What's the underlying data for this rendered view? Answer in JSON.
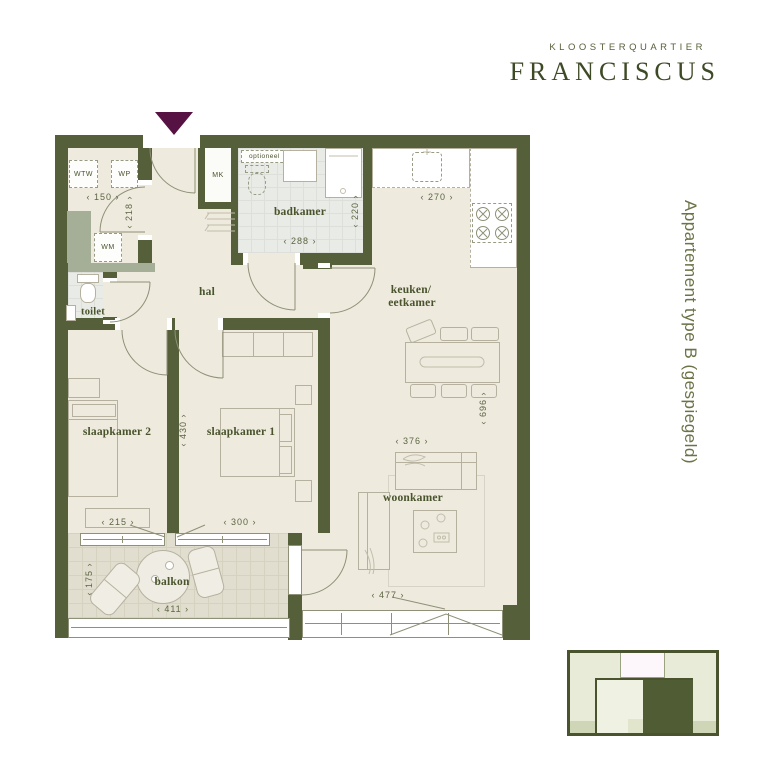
{
  "brand": {
    "subtitle": "KLOOSTERQUARTIER",
    "title": "FRANCISCUS"
  },
  "side_label": "Appartement type B (gespiegeld)",
  "rooms": {
    "badkamer": "badkamer",
    "hal": "hal",
    "toilet": "toilet",
    "keuken_line1": "keuken/",
    "keuken_line2": "eetkamer",
    "slaapkamer2": "slaapkamer 2",
    "slaapkamer1": "slaapkamer 1",
    "woonkamer": "woonkamer",
    "balkon": "balkon"
  },
  "closets": {
    "wtw": "WTW",
    "wp": "WP",
    "wm": "WM",
    "mk": "MK",
    "optioneel": "optioneel"
  },
  "dimensions_cm": {
    "entree_width": "‹ 150 ›",
    "entree_depth": "‹ 218 ›",
    "badkamer_width": "‹ 288 ›",
    "badkamer_depth": "‹ 220 ›",
    "keuken_width": "‹ 270 ›",
    "keuken_depth": "‹ 696 ›",
    "slaapkamer2_width": "‹ 215 ›",
    "slaapkamer1_width": "‹ 300 ›",
    "slaapkamer_depth": "‹ 430 ›",
    "woonkamer_width": "‹ 376 ›",
    "woonkamer_window": "‹ 477 ›",
    "balkon_width": "‹ 411 ›",
    "balkon_depth": "‹ 175 ›"
  },
  "colors": {
    "wall": "#55603a",
    "floor": "#eeeade",
    "tile": "#e9ebe6",
    "btile": "#e1decf",
    "ink": "#49542d",
    "dim-ink": "#5c6542",
    "logo-ink": "#3e4a26",
    "side-ink": "#6b7347",
    "accent": "#551243",
    "map-light": "#e7ebd8",
    "map-dark": "#505c34",
    "map-pink": "#fdf6fa"
  }
}
